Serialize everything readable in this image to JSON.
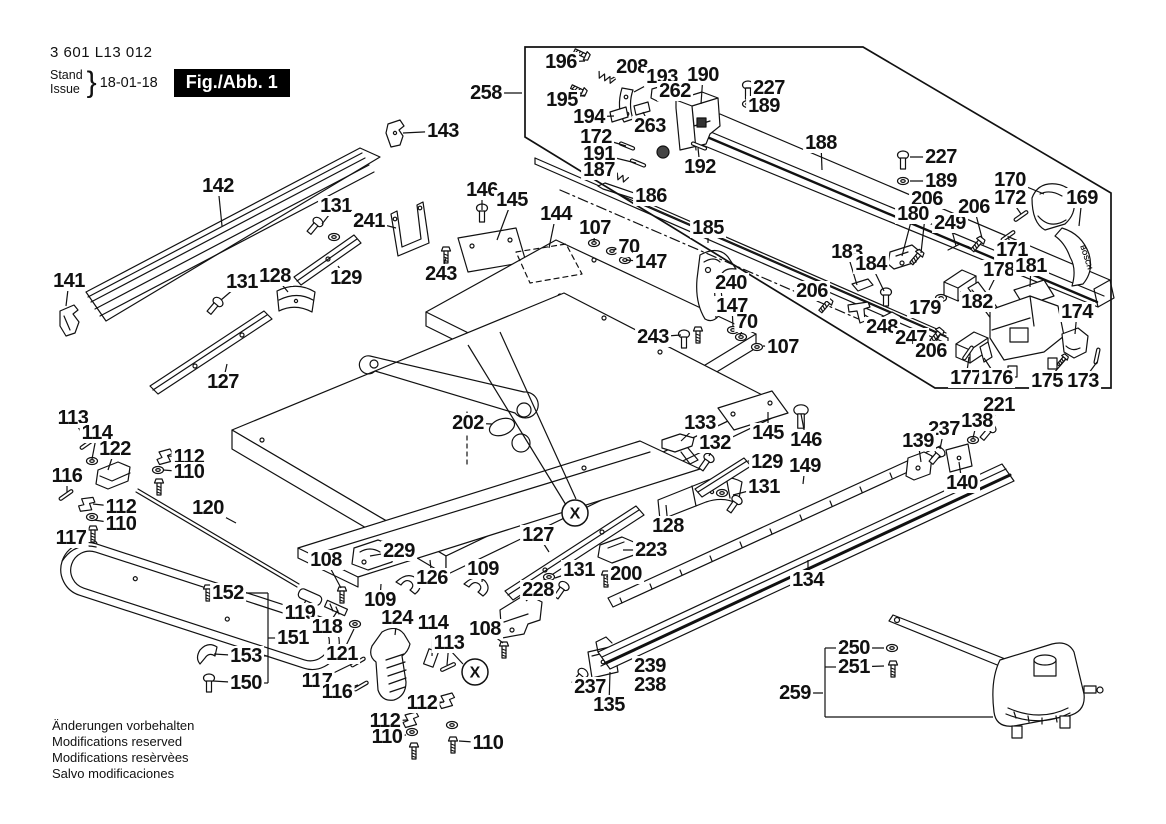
{
  "title_block": {
    "part_number": "3 601 L13 012",
    "stand_label": "Stand",
    "issue_label": "Issue",
    "brace": "}",
    "date": "18-01-18",
    "figure_label": "Fig./Abb. 1"
  },
  "footer_notes": [
    "Änderungen vorbehalten",
    "Modifications reserved",
    "Modifications resèrvèes",
    "Salvo modificaciones"
  ],
  "colors": {
    "ink": "#111111",
    "paper": "#ffffff"
  },
  "markings": [
    {
      "text": "BOSCH",
      "x": 1084,
      "y": 258,
      "rot": 72,
      "size": 7
    }
  ],
  "markers": [
    {
      "symbol": "X",
      "x": 575,
      "y": 513
    },
    {
      "symbol": "X",
      "x": 475,
      "y": 672
    }
  ],
  "assembly_box": [
    [
      525,
      47
    ],
    [
      863,
      47
    ],
    [
      1111,
      193
    ],
    [
      1111,
      388
    ],
    [
      935,
      388
    ],
    [
      525,
      137
    ]
  ],
  "bracket_lines": [
    [
      [
        244,
        593
      ],
      [
        268,
        593
      ]
    ],
    [
      [
        261,
        656
      ],
      [
        268,
        656
      ]
    ],
    [
      [
        261,
        683
      ],
      [
        268,
        683
      ]
    ],
    [
      [
        268,
        593
      ],
      [
        268,
        683
      ]
    ],
    [
      [
        268,
        638
      ],
      [
        280,
        638
      ]
    ],
    [
      [
        836,
        648
      ],
      [
        825,
        648
      ]
    ],
    [
      [
        836,
        667
      ],
      [
        825,
        667
      ]
    ],
    [
      [
        825,
        648
      ],
      [
        825,
        717
      ],
      [
        993,
        717
      ]
    ],
    [
      [
        468,
        345
      ],
      [
        566,
        505
      ]
    ],
    [
      [
        500,
        332
      ],
      [
        576,
        499
      ]
    ],
    [
      [
        463,
        664
      ],
      [
        450,
        650
      ]
    ]
  ],
  "labels": [
    {
      "t": "143",
      "x": 443,
      "y": 131,
      "tx": 403,
      "ty": 133
    },
    {
      "t": "142",
      "x": 218,
      "y": 186,
      "tx": 222,
      "ty": 226
    },
    {
      "t": "131",
      "x": 336,
      "y": 206,
      "tx": 322,
      "ty": 224
    },
    {
      "t": "241",
      "x": 369,
      "y": 221,
      "tx": 396,
      "ty": 228
    },
    {
      "t": "146",
      "x": 482,
      "y": 190,
      "tx": 482,
      "ty": 210
    },
    {
      "t": "145",
      "x": 512,
      "y": 200,
      "tx": 497,
      "ty": 240
    },
    {
      "t": "144",
      "x": 556,
      "y": 214,
      "tx": 549,
      "ty": 248
    },
    {
      "t": "107",
      "x": 595,
      "y": 228,
      "tx": 594,
      "ty": 241
    },
    {
      "t": "70",
      "x": 629,
      "y": 247,
      "tx": 613,
      "ty": 250
    },
    {
      "t": "147",
      "x": 651,
      "y": 262,
      "tx": 626,
      "ty": 260
    },
    {
      "t": "258",
      "x": 486,
      "y": 93,
      "tx": 522,
      "ty": 93
    },
    {
      "t": "196",
      "x": 561,
      "y": 62,
      "tx": 585,
      "ty": 61
    },
    {
      "t": "208",
      "x": 632,
      "y": 67,
      "tx": 611,
      "ty": 79
    },
    {
      "t": "193",
      "x": 662,
      "y": 77,
      "tx": 634,
      "ty": 92
    },
    {
      "t": "190",
      "x": 703,
      "y": 75,
      "tx": 701,
      "ty": 104
    },
    {
      "t": "227",
      "x": 769,
      "y": 88,
      "tx": 746,
      "ty": 88
    },
    {
      "t": "262",
      "x": 675,
      "y": 91,
      "tx": 661,
      "ty": 94
    },
    {
      "t": "189",
      "x": 764,
      "y": 106,
      "tx": 746,
      "ty": 104
    },
    {
      "t": "195",
      "x": 562,
      "y": 100,
      "tx": 585,
      "ty": 95
    },
    {
      "t": "194",
      "x": 589,
      "y": 117,
      "tx": 614,
      "ty": 116
    },
    {
      "t": "263",
      "x": 650,
      "y": 126,
      "tx": 643,
      "ty": 112
    },
    {
      "t": "172",
      "x": 596,
      "y": 137,
      "tx": 626,
      "ty": 146
    },
    {
      "t": "191",
      "x": 599,
      "y": 154,
      "tx": 636,
      "ty": 163
    },
    {
      "t": "187",
      "x": 599,
      "y": 170,
      "tx": 618,
      "ty": 177
    },
    {
      "t": "186",
      "x": 651,
      "y": 196,
      "tx": 634,
      "ty": 188
    },
    {
      "t": "192",
      "x": 700,
      "y": 167,
      "tx": 698,
      "ty": 148
    },
    {
      "t": "188",
      "x": 821,
      "y": 143,
      "tx": 822,
      "ty": 170
    },
    {
      "t": "185",
      "x": 708,
      "y": 228,
      "tx": 708,
      "ty": 243
    },
    {
      "t": "227",
      "x": 941,
      "y": 157,
      "tx": 910,
      "ty": 157
    },
    {
      "t": "189",
      "x": 941,
      "y": 181,
      "tx": 910,
      "ty": 181
    },
    {
      "t": "206",
      "x": 927,
      "y": 199,
      "tx": 921,
      "ty": 253
    },
    {
      "t": "180",
      "x": 913,
      "y": 214,
      "tx": 902,
      "ty": 256
    },
    {
      "t": "249",
      "x": 950,
      "y": 223,
      "tx": 956,
      "ty": 246
    },
    {
      "t": "206",
      "x": 974,
      "y": 207,
      "tx": 982,
      "ty": 238
    },
    {
      "t": "170",
      "x": 1010,
      "y": 180,
      "tx": 1044,
      "ty": 194
    },
    {
      "t": "172",
      "x": 1010,
      "y": 198,
      "tx": 1021,
      "ty": 214
    },
    {
      "t": "169",
      "x": 1082,
      "y": 198,
      "tx": 1079,
      "ty": 226
    },
    {
      "t": "171",
      "x": 1012,
      "y": 250,
      "tx": 1008,
      "ty": 236
    },
    {
      "t": "183",
      "x": 847,
      "y": 252,
      "tx": 857,
      "ty": 285
    },
    {
      "t": "184",
      "x": 871,
      "y": 264,
      "tx": 884,
      "ty": 291
    },
    {
      "t": "178",
      "x": 999,
      "y": 270,
      "tx": 989,
      "ty": 290
    },
    {
      "t": "181",
      "x": 1031,
      "y": 266,
      "tx": 1030,
      "ty": 287
    },
    {
      "t": "179",
      "x": 925,
      "y": 308,
      "tx": 940,
      "ty": 298
    },
    {
      "t": "182",
      "x": 977,
      "y": 302,
      "tx": 960,
      "ty": 292
    },
    {
      "t": "248",
      "x": 882,
      "y": 327,
      "tx": 865,
      "ty": 315
    },
    {
      "t": "247",
      "x": 911,
      "y": 338,
      "tx": 894,
      "ty": 324
    },
    {
      "t": "206",
      "x": 931,
      "y": 351,
      "tx": 941,
      "ty": 333
    },
    {
      "t": "174",
      "x": 1077,
      "y": 312,
      "tx": 1075,
      "ty": 334
    },
    {
      "t": "177",
      "x": 966,
      "y": 378,
      "tx": 969,
      "ty": 357
    },
    {
      "t": "176",
      "x": 997,
      "y": 378,
      "tx": 984,
      "ty": 358
    },
    {
      "t": "175",
      "x": 1047,
      "y": 381,
      "tx": 1066,
      "ty": 359
    },
    {
      "t": "173",
      "x": 1083,
      "y": 381,
      "tx": 1097,
      "ty": 362
    },
    {
      "t": "221",
      "x": 999,
      "y": 405,
      "tx": 990,
      "ty": 426
    },
    {
      "t": "138",
      "x": 977,
      "y": 421,
      "tx": 973,
      "ty": 438
    },
    {
      "t": "237",
      "x": 944,
      "y": 429,
      "tx": 940,
      "ty": 449
    },
    {
      "t": "139",
      "x": 918,
      "y": 441,
      "tx": 921,
      "ty": 462
    },
    {
      "t": "140",
      "x": 962,
      "y": 483,
      "tx": 959,
      "ty": 462
    },
    {
      "t": "149",
      "x": 805,
      "y": 466,
      "tx": 803,
      "ty": 484
    },
    {
      "t": "134",
      "x": 808,
      "y": 580,
      "tx": 808,
      "ty": 560
    },
    {
      "t": "133",
      "x": 700,
      "y": 423,
      "tx": 681,
      "ty": 441
    },
    {
      "t": "132",
      "x": 715,
      "y": 443,
      "tx": 709,
      "ty": 456
    },
    {
      "t": "145",
      "x": 768,
      "y": 433,
      "tx": 768,
      "ty": 412
    },
    {
      "t": "146",
      "x": 806,
      "y": 440,
      "tx": 801,
      "ty": 414
    },
    {
      "t": "129",
      "x": 767,
      "y": 462,
      "tx": 748,
      "ty": 461
    },
    {
      "t": "131",
      "x": 764,
      "y": 487,
      "tx": 733,
      "ty": 495
    },
    {
      "t": "128",
      "x": 668,
      "y": 526,
      "tx": 666,
      "ty": 505
    },
    {
      "t": "223",
      "x": 651,
      "y": 550,
      "tx": 623,
      "ty": 550
    },
    {
      "t": "200",
      "x": 626,
      "y": 574,
      "tx": 606,
      "ty": 577
    },
    {
      "t": "131",
      "x": 579,
      "y": 570,
      "tx": 555,
      "ty": 578
    },
    {
      "t": "228",
      "x": 538,
      "y": 590,
      "tx": 526,
      "ty": 601
    },
    {
      "t": "127",
      "x": 538,
      "y": 535,
      "tx": 549,
      "ty": 552
    },
    {
      "t": "202",
      "x": 468,
      "y": 423,
      "tx": 492,
      "ty": 424
    },
    {
      "t": "126",
      "x": 432,
      "y": 578,
      "tx": 430,
      "ty": 560
    },
    {
      "t": "108",
      "x": 326,
      "y": 560,
      "tx": 341,
      "ty": 588
    },
    {
      "t": "229",
      "x": 399,
      "y": 551,
      "tx": 370,
      "ty": 556
    },
    {
      "t": "109",
      "x": 380,
      "y": 600,
      "tx": 381,
      "ty": 584
    },
    {
      "t": "109",
      "x": 483,
      "y": 569,
      "tx": 482,
      "ty": 582
    },
    {
      "t": "108",
      "x": 485,
      "y": 629,
      "tx": 503,
      "ty": 643
    },
    {
      "t": "119",
      "x": 300,
      "y": 613,
      "tx": 306,
      "ty": 600
    },
    {
      "t": "118",
      "x": 327,
      "y": 627,
      "tx": 338,
      "ty": 610
    },
    {
      "t": "121",
      "x": 342,
      "y": 654,
      "tx": 354,
      "ty": 629
    },
    {
      "t": "124",
      "x": 397,
      "y": 618,
      "tx": 395,
      "ty": 635
    },
    {
      "t": "114",
      "x": 433,
      "y": 623,
      "tx": 432,
      "ty": 656
    },
    {
      "t": "113",
      "x": 449,
      "y": 643,
      "tx": 447,
      "ty": 665
    },
    {
      "t": "117",
      "x": 317,
      "y": 681,
      "tx": 356,
      "ty": 662
    },
    {
      "t": "116",
      "x": 337,
      "y": 692,
      "tx": 358,
      "ty": 685
    },
    {
      "t": "112",
      "x": 422,
      "y": 703,
      "tx": 444,
      "ty": 702
    },
    {
      "t": "112",
      "x": 385,
      "y": 721,
      "tx": 408,
      "ty": 720
    },
    {
      "t": "110",
      "x": 387,
      "y": 737,
      "tx": 406,
      "ty": 735
    },
    {
      "t": "110",
      "x": 488,
      "y": 743,
      "tx": 459,
      "ty": 741
    },
    {
      "t": "120",
      "x": 208,
      "y": 508,
      "tx": 236,
      "ty": 523
    },
    {
      "t": "113",
      "x": 73,
      "y": 418,
      "tx": 86,
      "ty": 441
    },
    {
      "t": "114",
      "x": 97,
      "y": 433,
      "tx": 92,
      "ty": 459
    },
    {
      "t": "122",
      "x": 115,
      "y": 449,
      "tx": 108,
      "ty": 470
    },
    {
      "t": "116",
      "x": 67,
      "y": 476,
      "tx": 67,
      "ty": 492
    },
    {
      "t": "112",
      "x": 189,
      "y": 457,
      "tx": 168,
      "ty": 456
    },
    {
      "t": "110",
      "x": 189,
      "y": 472,
      "tx": 163,
      "ty": 470
    },
    {
      "t": "112",
      "x": 121,
      "y": 507,
      "tx": 93,
      "ty": 504
    },
    {
      "t": "110",
      "x": 121,
      "y": 524,
      "tx": 94,
      "ty": 520
    },
    {
      "t": "117",
      "x": 71,
      "y": 538,
      "tx": 89,
      "ty": 546
    },
    {
      "t": "152",
      "x": 228,
      "y": 593,
      "tx": 211,
      "ty": 592
    },
    {
      "t": "151",
      "x": 293,
      "y": 638
    },
    {
      "t": "153",
      "x": 246,
      "y": 656,
      "tx": 214,
      "ty": 654
    },
    {
      "t": "150",
      "x": 246,
      "y": 683,
      "tx": 213,
      "ty": 681
    },
    {
      "t": "135",
      "x": 609,
      "y": 705,
      "tx": 610,
      "ty": 672
    },
    {
      "t": "237",
      "x": 590,
      "y": 687,
      "tx": 585,
      "ty": 677
    },
    {
      "t": "239",
      "x": 650,
      "y": 666,
      "tx": 640,
      "ty": 665
    },
    {
      "t": "238",
      "x": 650,
      "y": 685,
      "tx": 640,
      "ty": 681
    },
    {
      "t": "250",
      "x": 854,
      "y": 648,
      "tx": 884,
      "ty": 648
    },
    {
      "t": "251",
      "x": 854,
      "y": 667,
      "tx": 884,
      "ty": 666
    },
    {
      "t": "259",
      "x": 795,
      "y": 693,
      "tx": 823,
      "ty": 693
    },
    {
      "t": "141",
      "x": 69,
      "y": 281,
      "tx": 66,
      "ty": 306
    },
    {
      "t": "131",
      "x": 242,
      "y": 282,
      "tx": 221,
      "ty": 300
    },
    {
      "t": "128",
      "x": 275,
      "y": 276,
      "tx": 288,
      "ty": 292
    },
    {
      "t": "129",
      "x": 346,
      "y": 278,
      "tx": 338,
      "ty": 266
    },
    {
      "t": "127",
      "x": 223,
      "y": 382,
      "tx": 227,
      "ty": 364
    },
    {
      "t": "240",
      "x": 731,
      "y": 283,
      "tx": 714,
      "ty": 284
    },
    {
      "t": "147",
      "x": 732,
      "y": 306,
      "tx": 733,
      "ty": 327
    },
    {
      "t": "70",
      "x": 747,
      "y": 322,
      "tx": 740,
      "ty": 335
    },
    {
      "t": "107",
      "x": 783,
      "y": 347,
      "tx": 763,
      "ty": 346
    },
    {
      "t": "243",
      "x": 441,
      "y": 274,
      "tx": 446,
      "ty": 258
    },
    {
      "t": "243",
      "x": 653,
      "y": 337,
      "tx": 681,
      "ty": 335
    },
    {
      "t": "206",
      "x": 812,
      "y": 291,
      "tx": 829,
      "ty": 300
    }
  ]
}
